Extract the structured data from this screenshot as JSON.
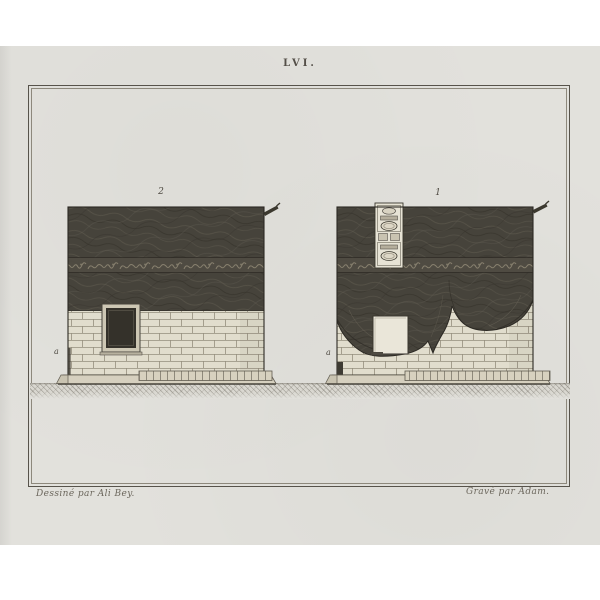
{
  "plate": {
    "title": "LVI.",
    "figures": [
      {
        "id": "fig-2",
        "label": "2",
        "corner_label": "a"
      },
      {
        "id": "fig-1",
        "label": "1",
        "corner_label": "a"
      }
    ],
    "credit_left": "Dessiné par Ali Bey.",
    "credit_right": "Gravé par Adam."
  },
  "colors": {
    "background": "#ffffff",
    "paper": "#e2e1dc",
    "frame_line": "#57534b",
    "ink": "#544f48",
    "drapery_dark": "#46433b",
    "inscription_band": "#4f4b42",
    "calligraphy": "#a49c85",
    "masonry": "#e1ddcd",
    "mortar": "#948e7d",
    "door_dark": "#34312a",
    "door_frame": "#cdc7b4",
    "plinth": "#d6d0bf",
    "ground": "#d9d7d0"
  }
}
